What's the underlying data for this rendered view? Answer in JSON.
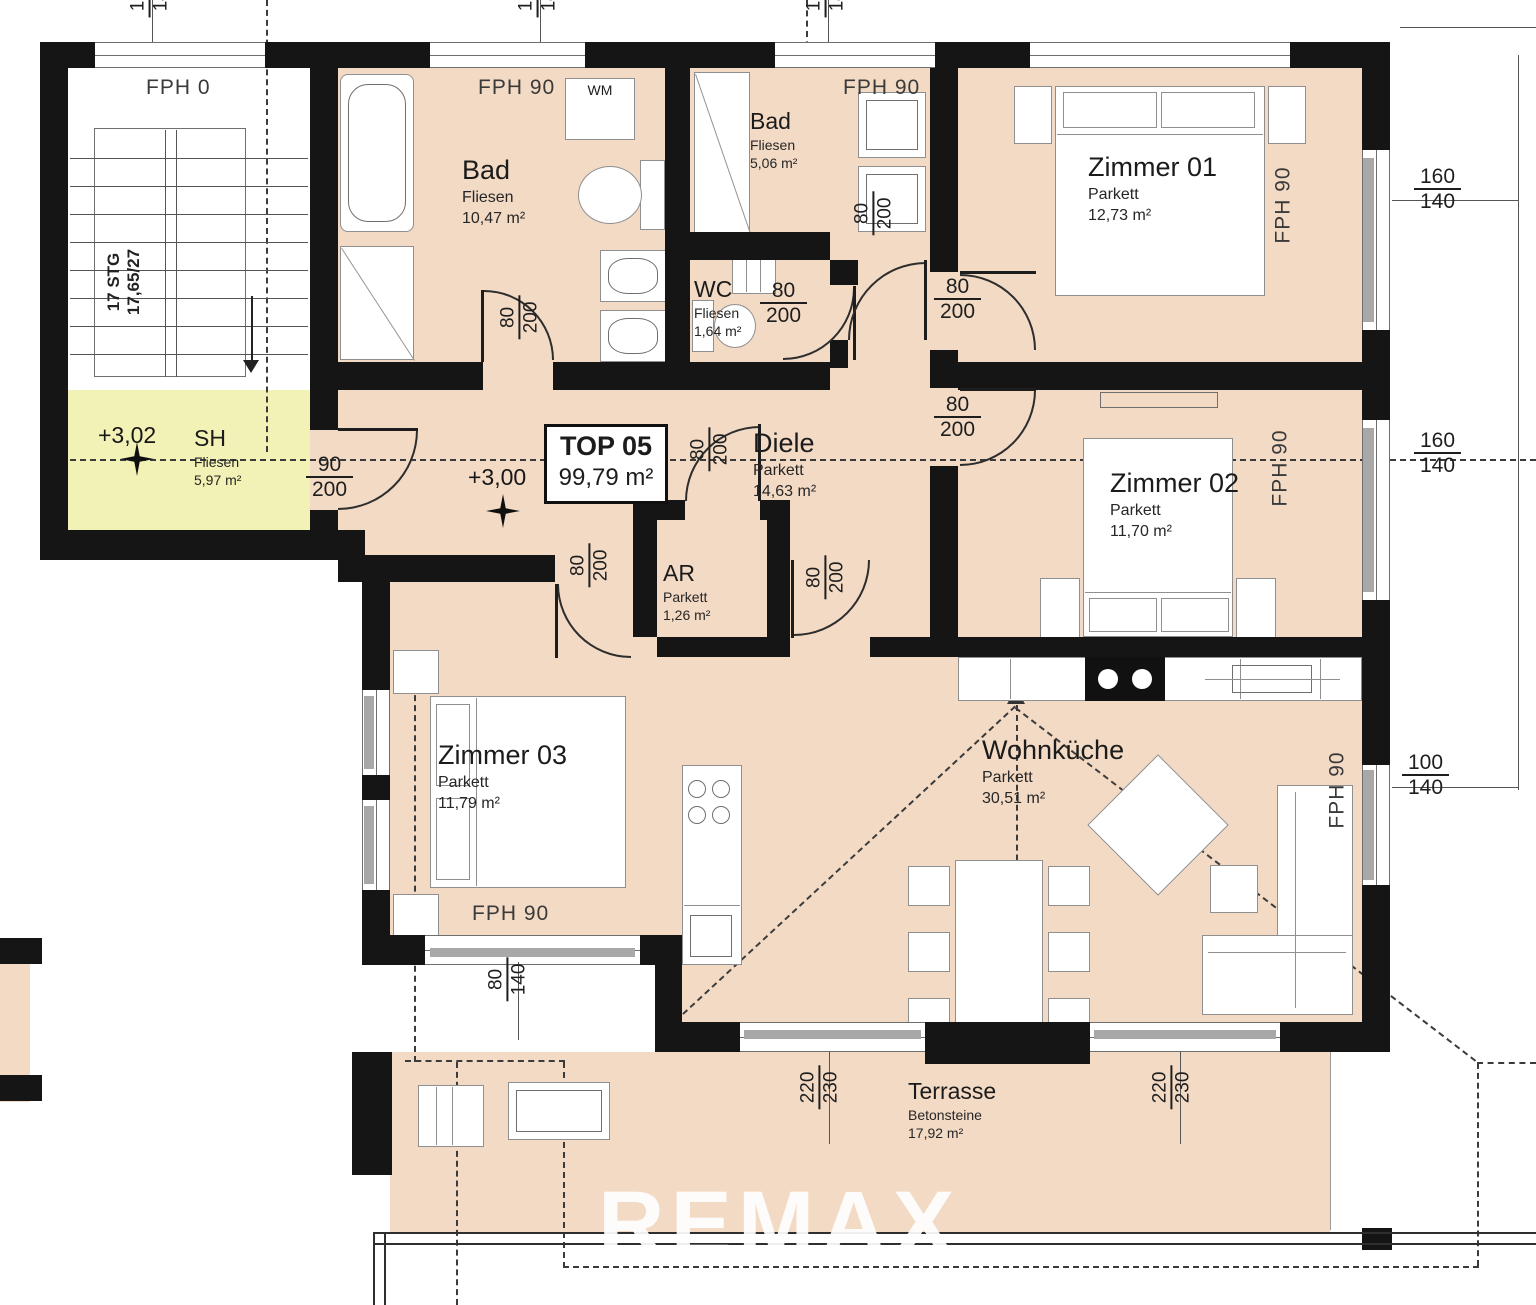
{
  "plan": {
    "unit_box": {
      "id": "TOP 05",
      "area": "99,79 m²"
    },
    "levels": {
      "stairwell": "+3,02",
      "apartment": "+3,00"
    },
    "stairwell": {
      "fph": "FPH 0",
      "stairs_line1": "17 STG",
      "stairs_line2": "17,65/27"
    },
    "watermark": "REMAX",
    "rooms": {
      "bad1": {
        "name": "Bad",
        "floor": "Fliesen",
        "area": "10,47 m²",
        "fph": "FPH 90"
      },
      "bad2": {
        "name": "Bad",
        "floor": "Fliesen",
        "area": "5,06 m²",
        "fph": "FPH 90"
      },
      "wc": {
        "name": "WC",
        "floor": "Fliesen",
        "area": "1,64 m²"
      },
      "ar": {
        "name": "AR",
        "floor": "Parkett",
        "area": "1,26 m²"
      },
      "sh": {
        "name": "SH",
        "floor": "Fliesen",
        "area": "5,97 m²"
      },
      "diele": {
        "name": "Diele",
        "floor": "Parkett",
        "area": "14,63 m²"
      },
      "zimmer1": {
        "name": "Zimmer 01",
        "floor": "Parkett",
        "area": "12,73 m²",
        "fph": "FPH 90"
      },
      "zimmer2": {
        "name": "Zimmer 02",
        "floor": "Parkett",
        "area": "11,70 m²",
        "fph": "FPH 90"
      },
      "zimmer3": {
        "name": "Zimmer 03",
        "floor": "Parkett",
        "area": "11,79 m²",
        "fph": "FPH 90"
      },
      "wohnkueche": {
        "name": "Wohnküche",
        "floor": "Parkett",
        "area": "30,51 m²",
        "fph": "FPH 90"
      },
      "terrasse": {
        "name": "Terrasse",
        "floor": "Betonsteine",
        "area": "17,92 m²"
      }
    },
    "appliances": {
      "wm": "WM"
    },
    "dims": {
      "d80": "80",
      "d90": "90",
      "d100": "100",
      "d140": "140",
      "d160": "160",
      "d200": "200",
      "d220": "220",
      "d230": "230"
    },
    "colors": {
      "wall": "#151515",
      "floor": "#f3dac5",
      "wet_room": "#f2f2b6",
      "accent_dash": "#3b3b3b"
    }
  }
}
